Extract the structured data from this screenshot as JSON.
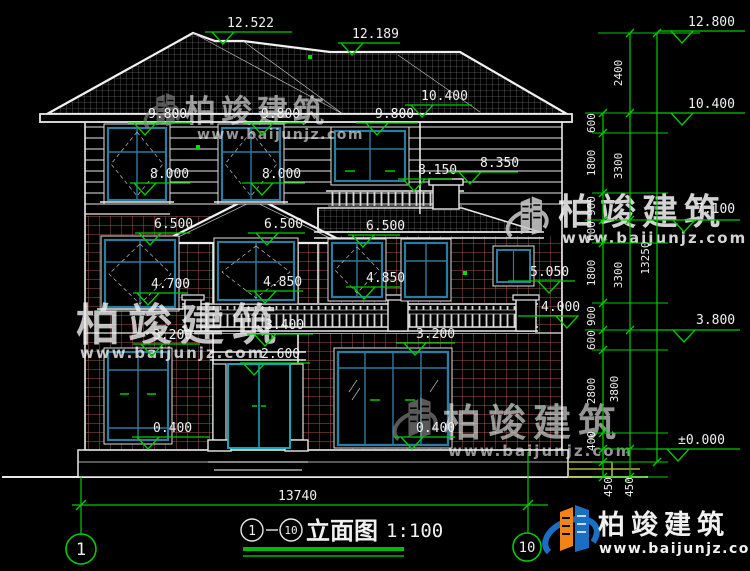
{
  "brand": {
    "name": "柏竣建筑",
    "url": "www.baijunjz.com"
  },
  "title": {
    "axis_start": "1",
    "axis_end": "10",
    "name": "立面图",
    "scale": "1:100"
  },
  "axes": {
    "start": "1",
    "end": "10"
  },
  "colors": {
    "dim_green": "#00cd00",
    "logo_blue": "#1a6fc4",
    "logo_orange": "#f08418",
    "brick": "#a2574a",
    "frame_blue": "#2b7c9e"
  },
  "marks": {
    "peak": "12.522",
    "ridge": "12.189",
    "r_top": "12.800",
    "roof_eave": "10.400",
    "r_eave": "10.400",
    "w3a": "9.800",
    "w3b": "9.800",
    "w3c": "9.800",
    "s3a": "8.000",
    "s3b": "8.000",
    "rail": "8.150",
    "cap": "8.350",
    "r_f3": "7.100",
    "w2a": "6.500",
    "w2b": "6.500",
    "w2c": "6.500",
    "s2a": "4.700",
    "s2b": "4.850",
    "s2c": "4.850",
    "s2d": "5.050",
    "balc_top": "4.000",
    "r_f2": "3.800",
    "balc_mid": "3.400",
    "w1a": "3.200",
    "w1b": "3.200",
    "door": "2.600",
    "s1a": "0.400",
    "s1b": "0.400",
    "ground": "±0.000"
  },
  "dims": {
    "seg_a": [
      "600",
      "1800",
      "900",
      "600",
      "1800",
      "900",
      "600",
      "2800",
      "400"
    ],
    "seg_b": [
      "2400",
      "3300",
      "3300",
      "3800"
    ],
    "found": [
      "450",
      "450"
    ],
    "total_h": "13250",
    "total_w": "13740"
  }
}
